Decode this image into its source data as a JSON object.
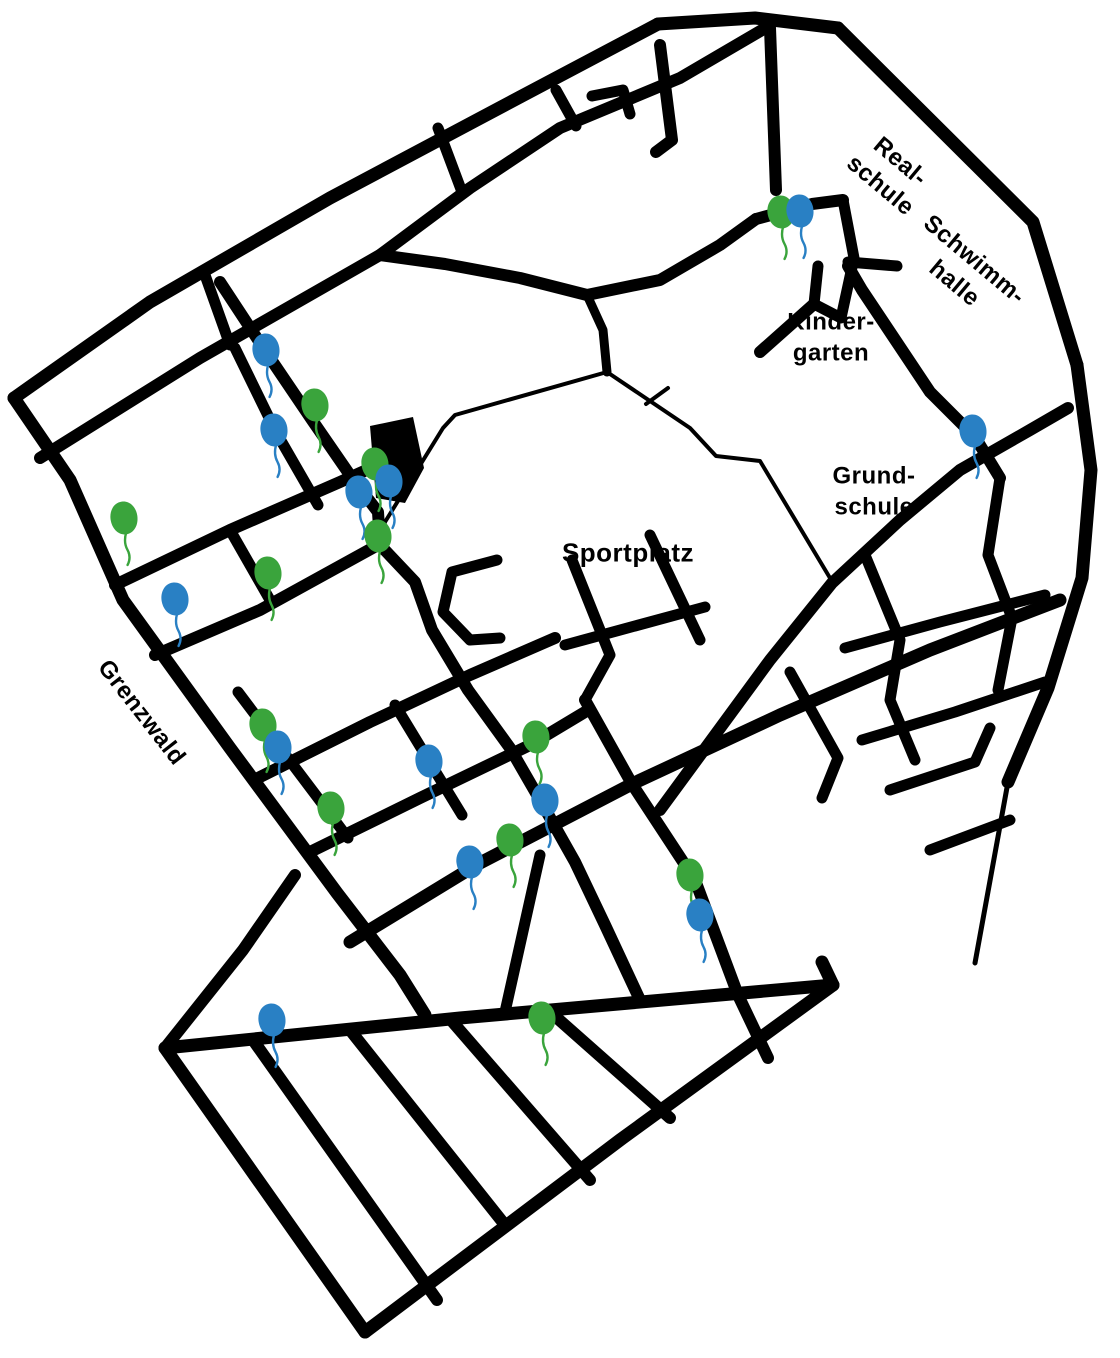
{
  "map": {
    "background_color": "#ffffff",
    "road_color": "#000000",
    "labels": {
      "sportplatz": {
        "text": "Sportplatz",
        "x": 628,
        "y": 553,
        "rotation": 0
      },
      "kindergarten": {
        "line1": "Kinder-",
        "line2": "garten",
        "x": 831,
        "y": 338,
        "rotation": 0
      },
      "grundschule": {
        "line1": "Grund-",
        "line2": "schule",
        "x": 874,
        "y": 492,
        "rotation": 0
      },
      "realschule": {
        "line1": "Real-",
        "line2": "schule",
        "x": 890,
        "y": 174,
        "rotation": 40
      },
      "schwimmhalle": {
        "line1": "Schwimm-",
        "line2": "halle",
        "x": 964,
        "y": 272,
        "rotation": 40
      },
      "grenzwald": {
        "text": "Grenzwald",
        "x": 141,
        "y": 713,
        "rotation": 52
      }
    },
    "marker_colors": {
      "green": "#3aa43c",
      "blue": "#2980c4"
    },
    "balloons": [
      {
        "color": "green",
        "x": 781,
        "y": 212
      },
      {
        "color": "blue",
        "x": 800,
        "y": 211
      },
      {
        "color": "blue",
        "x": 266,
        "y": 350
      },
      {
        "color": "green",
        "x": 315,
        "y": 405
      },
      {
        "color": "blue",
        "x": 274,
        "y": 430
      },
      {
        "color": "green",
        "x": 375,
        "y": 464
      },
      {
        "color": "blue",
        "x": 389,
        "y": 481
      },
      {
        "color": "blue",
        "x": 359,
        "y": 492
      },
      {
        "color": "green",
        "x": 378,
        "y": 536
      },
      {
        "color": "green",
        "x": 124,
        "y": 518
      },
      {
        "color": "blue",
        "x": 175,
        "y": 599
      },
      {
        "color": "green",
        "x": 268,
        "y": 573
      },
      {
        "color": "green",
        "x": 263,
        "y": 725
      },
      {
        "color": "blue",
        "x": 278,
        "y": 747
      },
      {
        "color": "green",
        "x": 331,
        "y": 808
      },
      {
        "color": "blue",
        "x": 429,
        "y": 761
      },
      {
        "color": "green",
        "x": 536,
        "y": 737
      },
      {
        "color": "blue",
        "x": 545,
        "y": 800
      },
      {
        "color": "green",
        "x": 510,
        "y": 840
      },
      {
        "color": "blue",
        "x": 470,
        "y": 862
      },
      {
        "color": "green",
        "x": 690,
        "y": 875
      },
      {
        "color": "blue",
        "x": 700,
        "y": 915
      },
      {
        "color": "blue",
        "x": 272,
        "y": 1020
      },
      {
        "color": "green",
        "x": 542,
        "y": 1018
      },
      {
        "color": "blue",
        "x": 973,
        "y": 431
      }
    ],
    "building": {
      "points": [
        [
          370,
          426
        ],
        [
          413,
          417
        ],
        [
          424,
          468
        ],
        [
          405,
          503
        ],
        [
          376,
          498
        ]
      ]
    },
    "roads": [
      {
        "w": 13,
        "pts": [
          [
            14,
            398
          ],
          [
            150,
            302
          ],
          [
            330,
            198
          ],
          [
            520,
            97
          ],
          [
            658,
            24
          ]
        ]
      },
      {
        "w": 13,
        "pts": [
          [
            658,
            24
          ],
          [
            755,
            18
          ],
          [
            838,
            28
          ]
        ]
      },
      {
        "w": 13,
        "pts": [
          [
            838,
            28
          ],
          [
            1033,
            222
          ],
          [
            1077,
            365
          ]
        ]
      },
      {
        "w": 13,
        "pts": [
          [
            1077,
            365
          ],
          [
            1091,
            470
          ],
          [
            1082,
            578
          ],
          [
            1048,
            688
          ],
          [
            1008,
            782
          ]
        ]
      },
      {
        "w": 5,
        "pts": [
          [
            1008,
            782
          ],
          [
            975,
            963
          ]
        ]
      },
      {
        "w": 13,
        "pts": [
          [
            14,
            398
          ],
          [
            70,
            480
          ],
          [
            123,
            600
          ],
          [
            230,
            748
          ],
          [
            337,
            893
          ],
          [
            400,
            975
          ],
          [
            425,
            1015
          ]
        ]
      },
      {
        "w": 12,
        "pts": [
          [
            40,
            458
          ],
          [
            200,
            358
          ],
          [
            380,
            255
          ],
          [
            470,
            188
          ],
          [
            560,
            128
          ],
          [
            680,
            78
          ],
          [
            762,
            30
          ]
        ]
      },
      {
        "w": 12,
        "pts": [
          [
            380,
            255
          ],
          [
            445,
            264
          ],
          [
            520,
            278
          ],
          [
            587,
            295
          ],
          [
            660,
            280
          ],
          [
            720,
            245
          ],
          [
            756,
            219
          ]
        ]
      },
      {
        "w": 11,
        "pts": [
          [
            205,
            275
          ],
          [
            230,
            345
          ]
        ]
      },
      {
        "w": 11,
        "pts": [
          [
            438,
            128
          ],
          [
            462,
            192
          ]
        ]
      },
      {
        "w": 11,
        "pts": [
          [
            556,
            90
          ],
          [
            576,
            126
          ]
        ]
      },
      {
        "w": 12,
        "pts": [
          [
            660,
            45
          ],
          [
            672,
            140
          ],
          [
            656,
            152
          ]
        ]
      },
      {
        "w": 11,
        "pts": [
          [
            592,
            96
          ],
          [
            623,
            90
          ],
          [
            630,
            114
          ]
        ]
      },
      {
        "w": 12,
        "pts": [
          [
            770,
            28
          ],
          [
            776,
            190
          ]
        ]
      },
      {
        "w": 12,
        "pts": [
          [
            756,
            219
          ],
          [
            812,
            204
          ],
          [
            843,
            200
          ]
        ]
      },
      {
        "w": 11,
        "pts": [
          [
            843,
            200
          ],
          [
            854,
            258
          ],
          [
            841,
            318
          ],
          [
            814,
            304
          ],
          [
            818,
            266
          ]
        ]
      },
      {
        "w": 12,
        "pts": [
          [
            814,
            304
          ],
          [
            760,
            352
          ]
        ]
      },
      {
        "w": 11,
        "pts": [
          [
            848,
            262
          ],
          [
            897,
            266
          ]
        ]
      },
      {
        "w": 12,
        "pts": [
          [
            848,
            266
          ],
          [
            862,
            290
          ],
          [
            930,
            392
          ],
          [
            975,
            437
          ],
          [
            1000,
            478
          ]
        ]
      },
      {
        "w": 9,
        "pts": [
          [
            587,
            295
          ],
          [
            603,
            330
          ],
          [
            607,
            372
          ]
        ]
      },
      {
        "w": 12,
        "pts": [
          [
            220,
            282
          ],
          [
            266,
            352
          ],
          [
            312,
            420
          ],
          [
            352,
            478
          ]
        ]
      },
      {
        "w": 11,
        "pts": [
          [
            235,
            348
          ],
          [
            276,
            432
          ],
          [
            318,
            505
          ]
        ]
      },
      {
        "w": 12,
        "pts": [
          [
            352,
            478
          ],
          [
            378,
            512
          ],
          [
            380,
            543
          ]
        ]
      },
      {
        "w": 12,
        "pts": [
          [
            115,
            585
          ],
          [
            230,
            530
          ],
          [
            340,
            482
          ],
          [
            400,
            455
          ]
        ]
      },
      {
        "w": 11,
        "pts": [
          [
            230,
            530
          ],
          [
            270,
            600
          ]
        ]
      },
      {
        "w": 12,
        "pts": [
          [
            155,
            655
          ],
          [
            260,
            610
          ],
          [
            378,
            545
          ]
        ]
      },
      {
        "w": 12,
        "pts": [
          [
            258,
            778
          ],
          [
            370,
            722
          ],
          [
            470,
            675
          ],
          [
            555,
            638
          ]
        ]
      },
      {
        "w": 12,
        "pts": [
          [
            310,
            852
          ],
          [
            420,
            798
          ],
          [
            530,
            745
          ],
          [
            585,
            712
          ]
        ]
      },
      {
        "w": 13,
        "pts": [
          [
            350,
            942
          ],
          [
            478,
            864
          ],
          [
            632,
            784
          ],
          [
            780,
            715
          ],
          [
            930,
            650
          ],
          [
            1060,
            600
          ]
        ]
      },
      {
        "w": 11,
        "pts": [
          [
            238,
            692
          ],
          [
            278,
            745
          ],
          [
            318,
            798
          ],
          [
            348,
            838
          ]
        ]
      },
      {
        "w": 11,
        "pts": [
          [
            395,
            705
          ],
          [
            429,
            761
          ],
          [
            462,
            815
          ]
        ]
      },
      {
        "w": 12,
        "pts": [
          [
            380,
            545
          ],
          [
            415,
            582
          ],
          [
            432,
            630
          ],
          [
            468,
            690
          ],
          [
            510,
            748
          ],
          [
            540,
            800
          ],
          [
            575,
            862
          ],
          [
            605,
            925
          ],
          [
            640,
            1000
          ]
        ]
      },
      {
        "w": 11,
        "pts": [
          [
            572,
            560
          ],
          [
            610,
            655
          ],
          [
            585,
            700
          ]
        ]
      },
      {
        "w": 11,
        "pts": [
          [
            650,
            535
          ],
          [
            700,
            640
          ]
        ]
      },
      {
        "w": 11,
        "pts": [
          [
            565,
            645
          ],
          [
            705,
            607
          ]
        ]
      },
      {
        "w": 12,
        "pts": [
          [
            585,
            700
          ],
          [
            632,
            784
          ],
          [
            695,
            880
          ],
          [
            738,
            995
          ],
          [
            768,
            1058
          ]
        ]
      },
      {
        "w": 12,
        "pts": [
          [
            660,
            810
          ],
          [
            770,
            660
          ],
          [
            832,
            583
          ],
          [
            900,
            520
          ],
          [
            960,
            470
          ],
          [
            1030,
            430
          ],
          [
            1068,
            408
          ]
        ]
      },
      {
        "w": 11,
        "pts": [
          [
            865,
            555
          ],
          [
            900,
            640
          ],
          [
            890,
            700
          ],
          [
            915,
            760
          ]
        ]
      },
      {
        "w": 11,
        "pts": [
          [
            1000,
            478
          ],
          [
            988,
            555
          ],
          [
            1012,
            618
          ],
          [
            998,
            690
          ]
        ]
      },
      {
        "w": 11,
        "pts": [
          [
            845,
            648
          ],
          [
            940,
            622
          ],
          [
            1045,
            595
          ]
        ]
      },
      {
        "w": 11,
        "pts": [
          [
            862,
            740
          ],
          [
            955,
            712
          ],
          [
            1045,
            682
          ]
        ]
      },
      {
        "w": 11,
        "pts": [
          [
            890,
            790
          ],
          [
            975,
            762
          ],
          [
            990,
            728
          ]
        ]
      },
      {
        "w": 11,
        "pts": [
          [
            930,
            850
          ],
          [
            1010,
            820
          ]
        ]
      },
      {
        "w": 11,
        "pts": [
          [
            790,
            672
          ],
          [
            838,
            758
          ],
          [
            822,
            798
          ]
        ]
      },
      {
        "w": 11,
        "pts": [
          [
            497,
            560
          ],
          [
            452,
            572
          ],
          [
            443,
            612
          ],
          [
            470,
            640
          ],
          [
            500,
            638
          ]
        ]
      },
      {
        "w": 11,
        "pts": [
          [
            505,
            1012
          ],
          [
            540,
            855
          ]
        ]
      },
      {
        "w": 12,
        "pts": [
          [
            165,
            1048
          ],
          [
            243,
            950
          ],
          [
            295,
            875
          ]
        ]
      },
      {
        "w": 13,
        "pts": [
          [
            165,
            1048
          ],
          [
            460,
            1018
          ],
          [
            833,
            985
          ],
          [
            822,
            962
          ]
        ]
      },
      {
        "w": 13,
        "pts": [
          [
            165,
            1048
          ],
          [
            365,
            1332
          ]
        ]
      },
      {
        "w": 13,
        "pts": [
          [
            365,
            1332
          ],
          [
            620,
            1140
          ],
          [
            833,
            985
          ]
        ]
      },
      {
        "w": 12,
        "pts": [
          [
            253,
            1040
          ],
          [
            437,
            1300
          ]
        ]
      },
      {
        "w": 12,
        "pts": [
          [
            350,
            1030
          ],
          [
            505,
            1225
          ]
        ]
      },
      {
        "w": 12,
        "pts": [
          [
            450,
            1019
          ],
          [
            590,
            1180
          ]
        ]
      },
      {
        "w": 12,
        "pts": [
          [
            548,
            1010
          ],
          [
            670,
            1118
          ]
        ]
      },
      {
        "w": 4,
        "pts": [
          [
            607,
            372
          ],
          [
            455,
            415
          ],
          [
            443,
            428
          ],
          [
            385,
            522
          ],
          [
            380,
            543
          ]
        ]
      },
      {
        "w": 4,
        "pts": [
          [
            607,
            372
          ],
          [
            690,
            428
          ],
          [
            716,
            456
          ],
          [
            760,
            461
          ],
          [
            830,
            578
          ]
        ]
      },
      {
        "w": 4,
        "pts": [
          [
            646,
            404
          ],
          [
            668,
            388
          ]
        ]
      }
    ]
  }
}
